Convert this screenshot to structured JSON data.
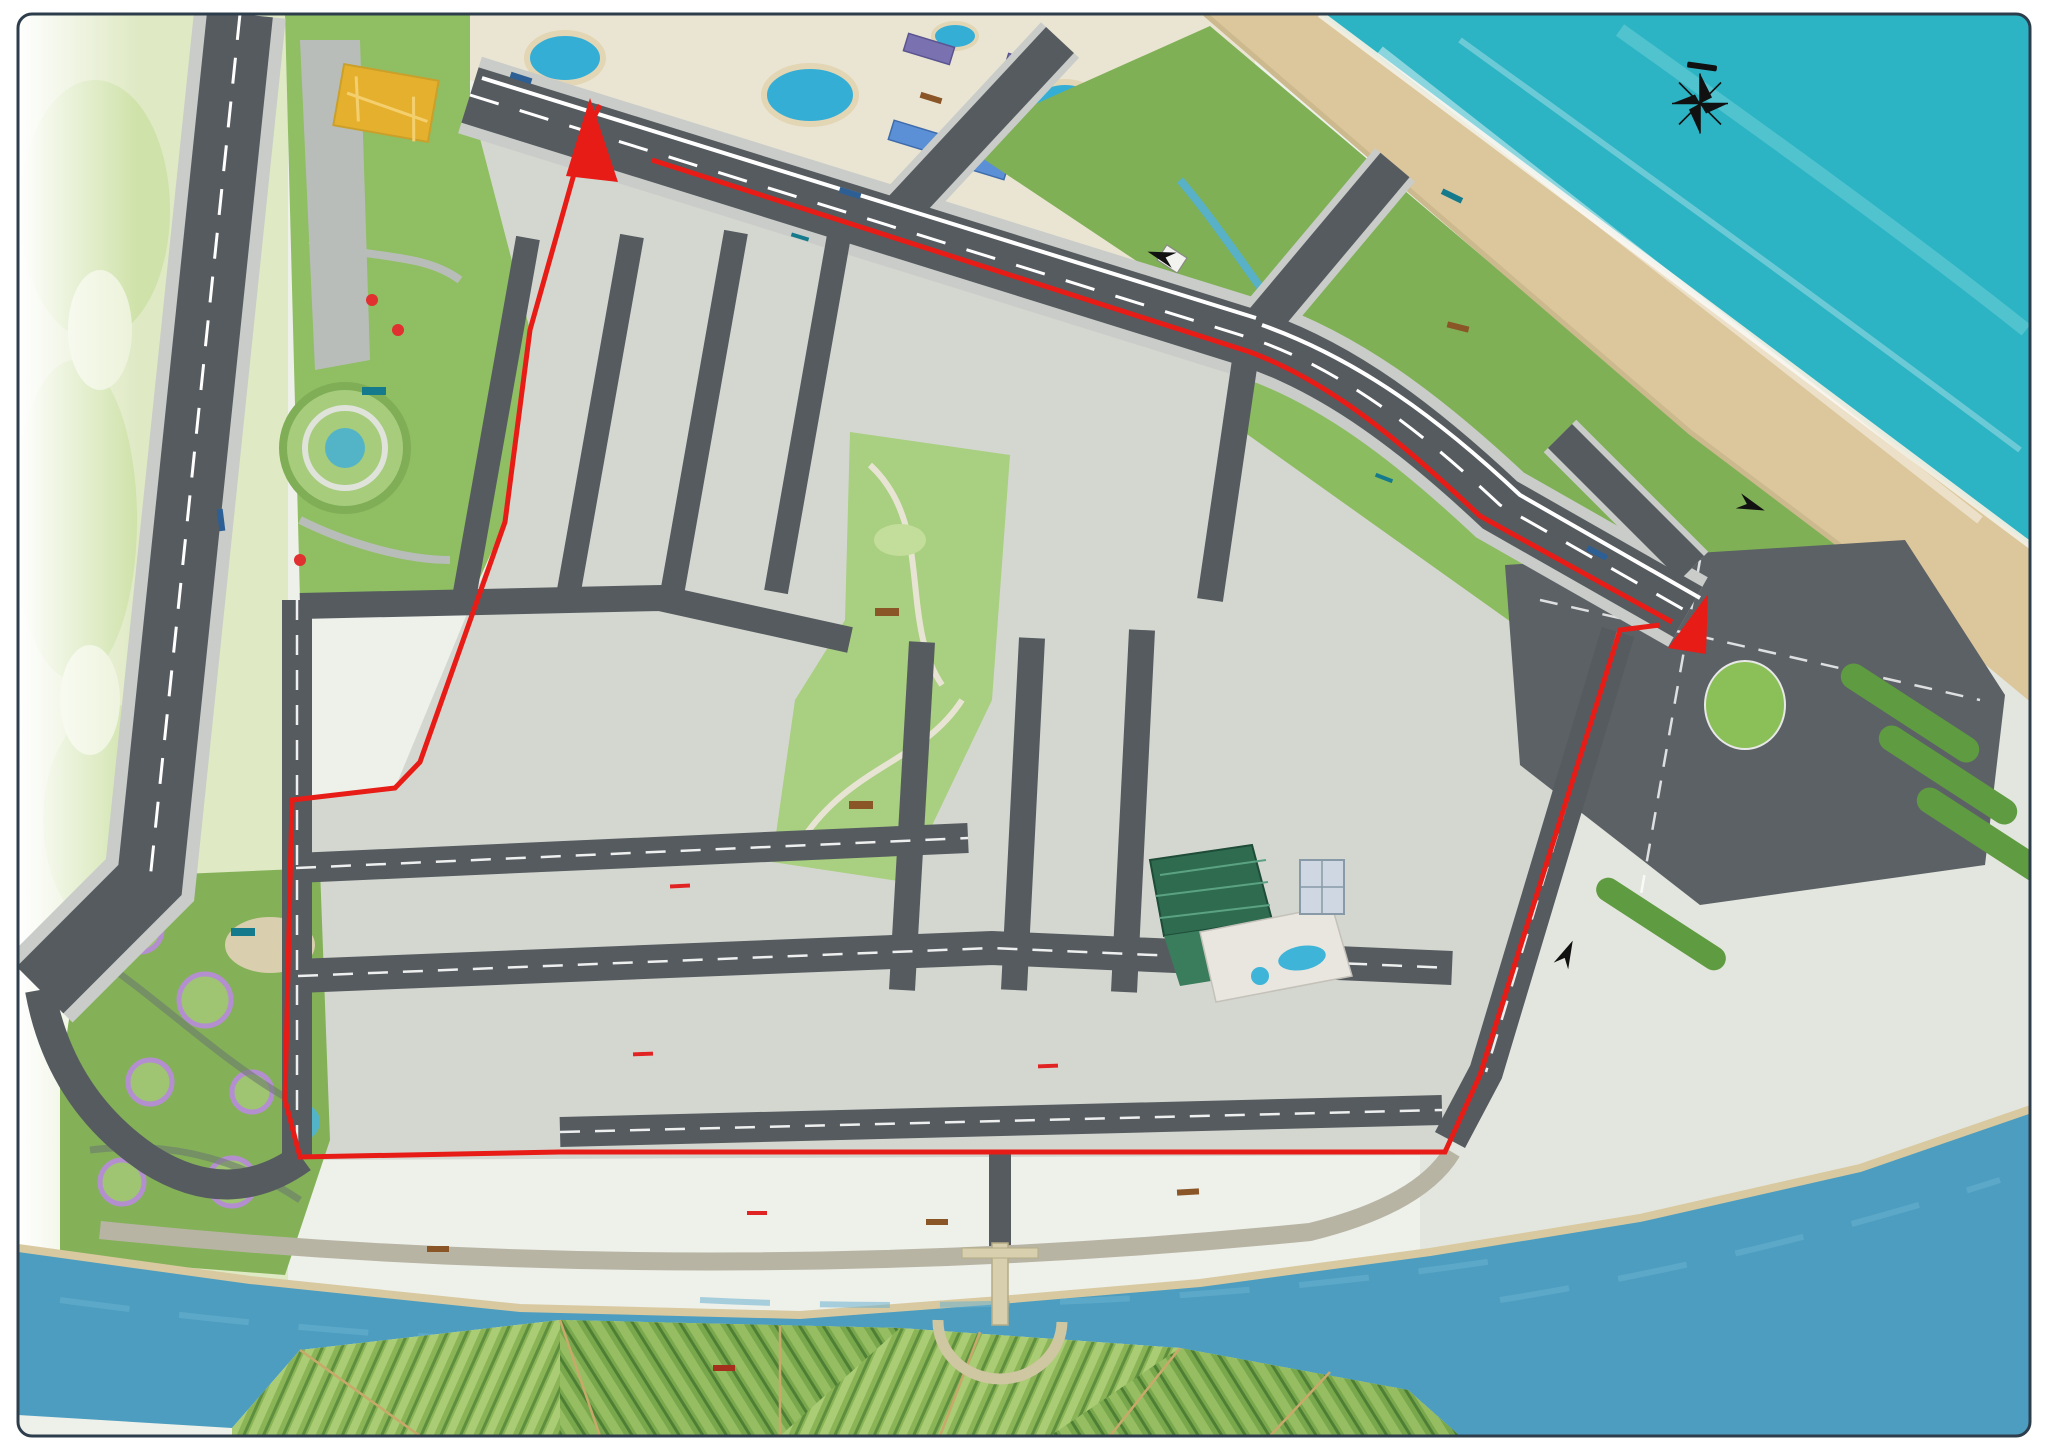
{
  "texts": {
    "dir_da_nang": "HƯỚNG ĐI ĐÀ NẴNG",
    "road_lac_long_quan": "ĐƯỜNG LẠC LONG QUÂN",
    "resort": "HỘI AN GOLDEN SEA",
    "beach_label": "BÃI BIỂN AN BÀNG",
    "sea_label": "BIỂN AN BÀNG",
    "homestay": "HOMESTAY",
    "road_hai_ba_trung": "ĐƯỜNG HAI BÀ TRƯNG",
    "square_l1": "QUẢNG TRƯỜNG",
    "square_l2": "TRUNG TÂM HỘI AN",
    "park_internal": "CÔNG VIÊN NỘI KHU",
    "park_l1": "CÔNG VIÊN",
    "park_l2": "NỘI KHU",
    "dir_cua_dai": "HƯỚNG ĐI CỬA ĐẠI",
    "riverside_park": "CÔNG VIÊN BỜ SÔNG",
    "marina": "BẾN DU THUYỀN",
    "river_name": "SÔNG CỔ CÒ",
    "village": "LÀNG RAU TRÀ QUẾ",
    "compass_north": "B"
  },
  "colors": {
    "label_blue": "#2d5f94",
    "label_teal": "#157a8c",
    "label_brown": "#8a5527",
    "label_darkred": "#a52f1d",
    "zone_red": "#e02424",
    "boundary_red": "#e81c16",
    "sea": "#2cb4c4",
    "sand": "#dcc79c",
    "river": "#4d9dc0",
    "road": "#565b60",
    "park_green": "#8fbe63",
    "plot_white": "#ffffff"
  },
  "zones_rv": {
    "rv4t": {
      "top": [
        "38",
        "37",
        "36",
        "35",
        "34",
        "33",
        "32",
        "31",
        "30",
        "29",
        "28",
        "27",
        "26",
        "25",
        "24",
        "23"
      ],
      "bottom": [
        "01",
        "02",
        "03",
        "04",
        "05",
        "06",
        "07",
        "08",
        "09",
        "10",
        "11",
        "12",
        "13",
        "14"
      ]
    },
    "rv4b": {
      "label": "RV-04",
      "row": [
        "01",
        "02",
        "03",
        "04",
        "05",
        "06",
        "07",
        "08",
        "09",
        "10",
        "11",
        "12",
        "13",
        "14",
        "15",
        "16",
        "17",
        "18",
        "19",
        "20"
      ]
    },
    "rv3": {
      "label": "RV-03",
      "top": [
        "33",
        "32",
        "31",
        "30",
        "29",
        "28",
        "27",
        "26",
        "25",
        "24",
        "23",
        "22",
        "21",
        "20",
        "19",
        "18",
        "17",
        "16"
      ],
      "bottom": [
        "01",
        "02",
        "03",
        "04",
        "05",
        "06",
        "07",
        "08",
        "09",
        "10",
        "11",
        "12",
        "13",
        "14",
        "15"
      ],
      "note": "14.0M X 13.0 = 182.0M"
    },
    "rv2": {
      "label": "RV-02",
      "top": [
        "43",
        "42",
        "41",
        "40",
        "39",
        "38",
        "37",
        "36",
        "35",
        "34",
        "33",
        "32",
        "31",
        "30",
        "29",
        "28"
      ],
      "bottom": [
        "01",
        "02",
        "03",
        "04",
        "05",
        "06",
        "07",
        "08",
        "09"
      ]
    },
    "rv1": {
      "label": "RV-01",
      "row": [
        "18",
        "17",
        "16",
        "15",
        "14",
        "13",
        "12",
        "11",
        "10",
        "09",
        "08",
        "07",
        "06",
        "05",
        "04",
        "03",
        "02",
        "01"
      ]
    }
  },
  "strips": {
    "ul1": {
      "a": [
        "19",
        "20",
        "22",
        "23",
        "25",
        "27",
        "29",
        "31",
        "33",
        "34",
        "35",
        "36"
      ],
      "b": [
        "17",
        "16",
        "15",
        "14",
        "13",
        "12",
        "11",
        "10",
        "09",
        "08",
        "07",
        "06"
      ]
    },
    "ul2": {
      "a": [
        "16",
        "17",
        "18",
        "19",
        "20",
        "21",
        "22",
        "23",
        "24",
        "25",
        "26",
        "27"
      ],
      "b": [
        "15",
        "14",
        "13",
        "12",
        "11",
        "10",
        "09",
        "08",
        "07",
        "06",
        "05",
        "04"
      ]
    },
    "ul3": {
      "a": [
        "18",
        "19",
        "20",
        "21",
        "22",
        "23",
        "24",
        "25",
        "26",
        "27",
        "28",
        "29"
      ],
      "b": [
        "17",
        "16",
        "15",
        "14",
        "13",
        "12",
        "11",
        "10",
        "09",
        "08",
        "07",
        "06"
      ]
    },
    "ul4": {
      "a": [
        "16",
        "17",
        "18",
        "19",
        "20",
        "21",
        "22"
      ],
      "b": [
        "15",
        "14",
        "13",
        "12",
        "11",
        "10",
        "09"
      ]
    },
    "lcol": {
      "a": [
        "36",
        "37",
        "38",
        "39",
        "40",
        "41",
        "42",
        "43"
      ]
    },
    "ca": {
      "a": [
        "22",
        "23",
        "24",
        "25",
        "26",
        "27",
        "28",
        "29",
        "30",
        "31",
        "32",
        "33"
      ],
      "b": [
        "12",
        "11",
        "10",
        "09",
        "08",
        "07",
        "06",
        "05",
        "04",
        "03",
        "02",
        "01"
      ]
    },
    "cb": {
      "a": [
        "12",
        "11",
        "10",
        "09",
        "08",
        "07",
        "06",
        "05",
        "04",
        "03",
        "02",
        "01"
      ],
      "b": [
        "12",
        "11",
        "10",
        "09",
        "08",
        "07",
        "06",
        "05",
        "04",
        "03",
        "02",
        "01"
      ]
    },
    "ra": {
      "top": [
        "01",
        "02",
        "03",
        "04",
        "05",
        "06",
        "07",
        "08",
        "09",
        "10",
        "11",
        "12",
        "13"
      ],
      "bottom": [
        "26",
        "25",
        "24",
        "23",
        "22",
        "21",
        "20",
        "19",
        "18",
        "17",
        "16",
        "15",
        "14"
      ]
    },
    "rb": {
      "a": [
        "31",
        "30",
        "29",
        "28",
        "27",
        "26",
        "25"
      ],
      "b": [
        "01",
        "02",
        "03",
        "04",
        "05",
        "06",
        "07"
      ]
    },
    "rc": {
      "top": [
        "37",
        "36",
        "35",
        "34",
        "33",
        "32",
        "31",
        "30",
        "29",
        "28",
        "27"
      ],
      "bottom": [
        "17",
        "18",
        "19",
        "20",
        "21",
        "22",
        "23",
        "24",
        "25",
        "26"
      ]
    }
  },
  "dims": [
    {
      "v": [
        "4.0",
        "11.5"
      ],
      "x": 498,
      "y": 525,
      "r": -78
    },
    {
      "v": [
        "2.0",
        "2.0",
        "7.5"
      ],
      "x": 678,
      "y": 556,
      "r": -15
    },
    {
      "v": [
        "2.0",
        "2.0",
        "7.5"
      ],
      "x": 797,
      "y": 438,
      "r": -80
    },
    {
      "v": [
        "4.0",
        "4.0",
        "7.5"
      ],
      "x": 1048,
      "y": 482,
      "r": -60
    },
    {
      "v": [
        "5.0",
        "17.0",
        "5.0"
      ],
      "x": 1274,
      "y": 372,
      "r": -70
    },
    {
      "v": [
        "3.0",
        "3.0",
        "7.5"
      ],
      "x": 699,
      "y": 978,
      "r": -85
    },
    {
      "v": [
        "3.0",
        "3.0",
        "7.5"
      ],
      "x": 1270,
      "y": 1152,
      "r": -75
    },
    {
      "v": [
        "2.0",
        "2.0",
        "7.5"
      ],
      "x": 1042,
      "y": 871,
      "r": 0
    },
    {
      "v": [
        "12.5"
      ],
      "x": 527,
      "y": 434,
      "r": 0
    }
  ],
  "dim_rows": [
    {
      "t": "8.0",
      "x": 568,
      "y": 1133,
      "n": 11,
      "dx": 27
    },
    {
      "t": "14.0",
      "x": 995,
      "y": 1112,
      "n": 7,
      "dx": 46
    }
  ]
}
